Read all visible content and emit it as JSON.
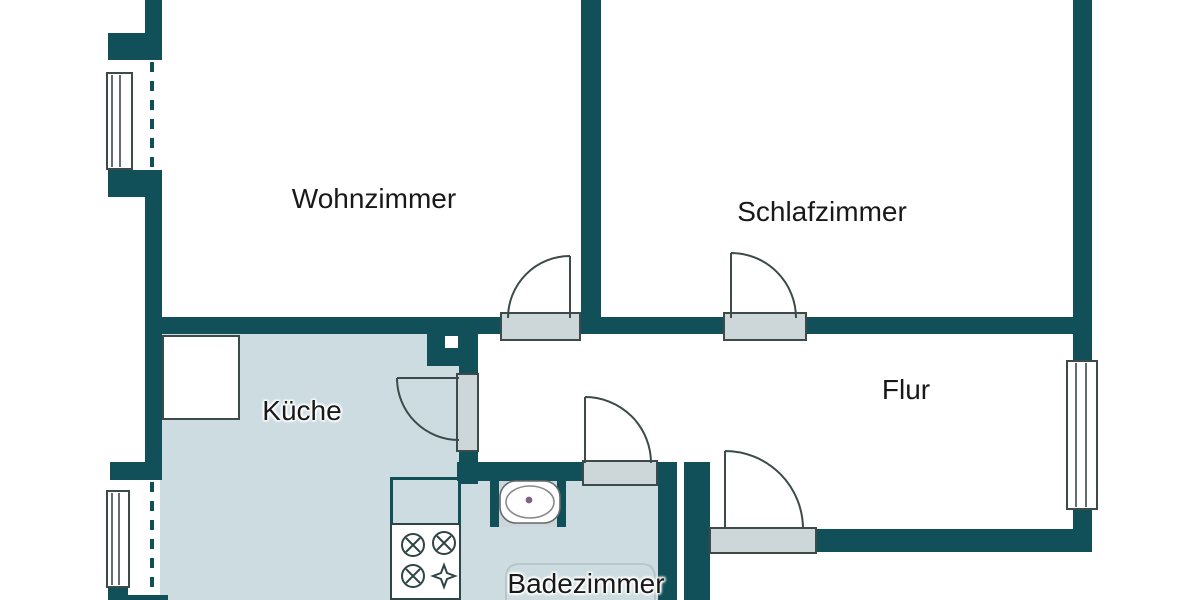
{
  "plan": {
    "type": "floor-plan",
    "rooms": [
      {
        "id": "wohnzimmer",
        "label": "Wohnzimmer"
      },
      {
        "id": "schlafzimmer",
        "label": "Schlafzimmer"
      },
      {
        "id": "kueche",
        "label": "Küche"
      },
      {
        "id": "flur",
        "label": "Flur"
      },
      {
        "id": "badezimmer",
        "label": "Badezimmer"
      }
    ],
    "colors": {
      "wall": "#115058",
      "room_fill": "#ccdce0",
      "door_sill": "#cdd7da",
      "line": "#3c4a4a",
      "background": "#ffffff",
      "label_text": "#191919"
    },
    "doors": [
      {
        "room": "Wohnzimmer",
        "swing": "into room, hinge right"
      },
      {
        "room": "Schlafzimmer",
        "swing": "into room, hinge left"
      },
      {
        "room": "Küche",
        "swing": "into room, hinge top"
      },
      {
        "room": "Badezimmer",
        "swing": "into hallway, hinge left"
      },
      {
        "room": "Flur",
        "swing": "into hallway, hinge left"
      }
    ],
    "windows": [
      {
        "wall": "left, upper (Wohnzimmer)"
      },
      {
        "wall": "left, lower (Küche)"
      },
      {
        "wall": "right (Flur)"
      }
    ],
    "fixtures": [
      {
        "name": "stove",
        "burners": 4,
        "room": "Küche"
      },
      {
        "name": "kitchen-cupboard",
        "room": "Küche"
      },
      {
        "name": "washbasin",
        "room": "Badezimmer"
      },
      {
        "name": "bathtub",
        "room": "Badezimmer"
      }
    ]
  }
}
